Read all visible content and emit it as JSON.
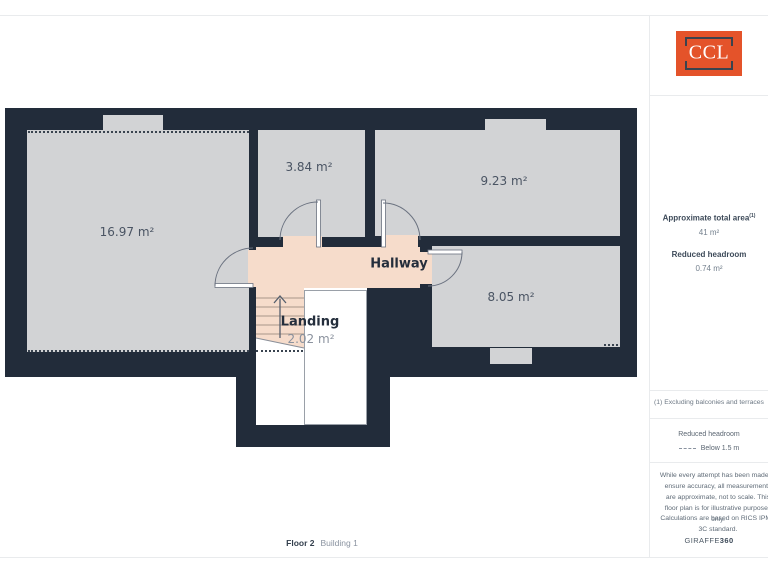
{
  "brand": {
    "logo_text": "CCL"
  },
  "floorplan": {
    "rooms": {
      "room1": {
        "area": "16.97 m²"
      },
      "room2": {
        "area": "3.84 m²"
      },
      "room3": {
        "area": "9.23 m²"
      },
      "room4": {
        "area": "8.05 m²"
      },
      "hallway": {
        "label": "Hallway"
      },
      "landing": {
        "label": "Landing",
        "area": "2.02 m²"
      }
    },
    "footer": {
      "floor": "Floor 2",
      "building": "Building 1"
    }
  },
  "sidebar": {
    "total_area_label": "Approximate total area",
    "total_area_sup": "(1)",
    "total_area_value": "41 m²",
    "reduced_headroom_label": "Reduced headroom",
    "reduced_headroom_value": "0.74 m²",
    "footnote": "(1) Excluding balconies and terraces",
    "legend_title": "Reduced headroom",
    "legend_item": "Below 1.5 m",
    "disclaimer": "While every attempt has been made to ensure accuracy, all measurements are approximate, not to scale. This floor plan is for illustrative purposes only.",
    "standard_note": "Calculations are based on RICS IPMS 3C standard.",
    "brand_name": "GIRAFFE",
    "brand_suffix": "360"
  },
  "colors": {
    "wall": "#222c3a",
    "room_fill": "#d2d3d5",
    "hallway_fill": "#f6dccb",
    "accent_orange": "#e4532a"
  }
}
